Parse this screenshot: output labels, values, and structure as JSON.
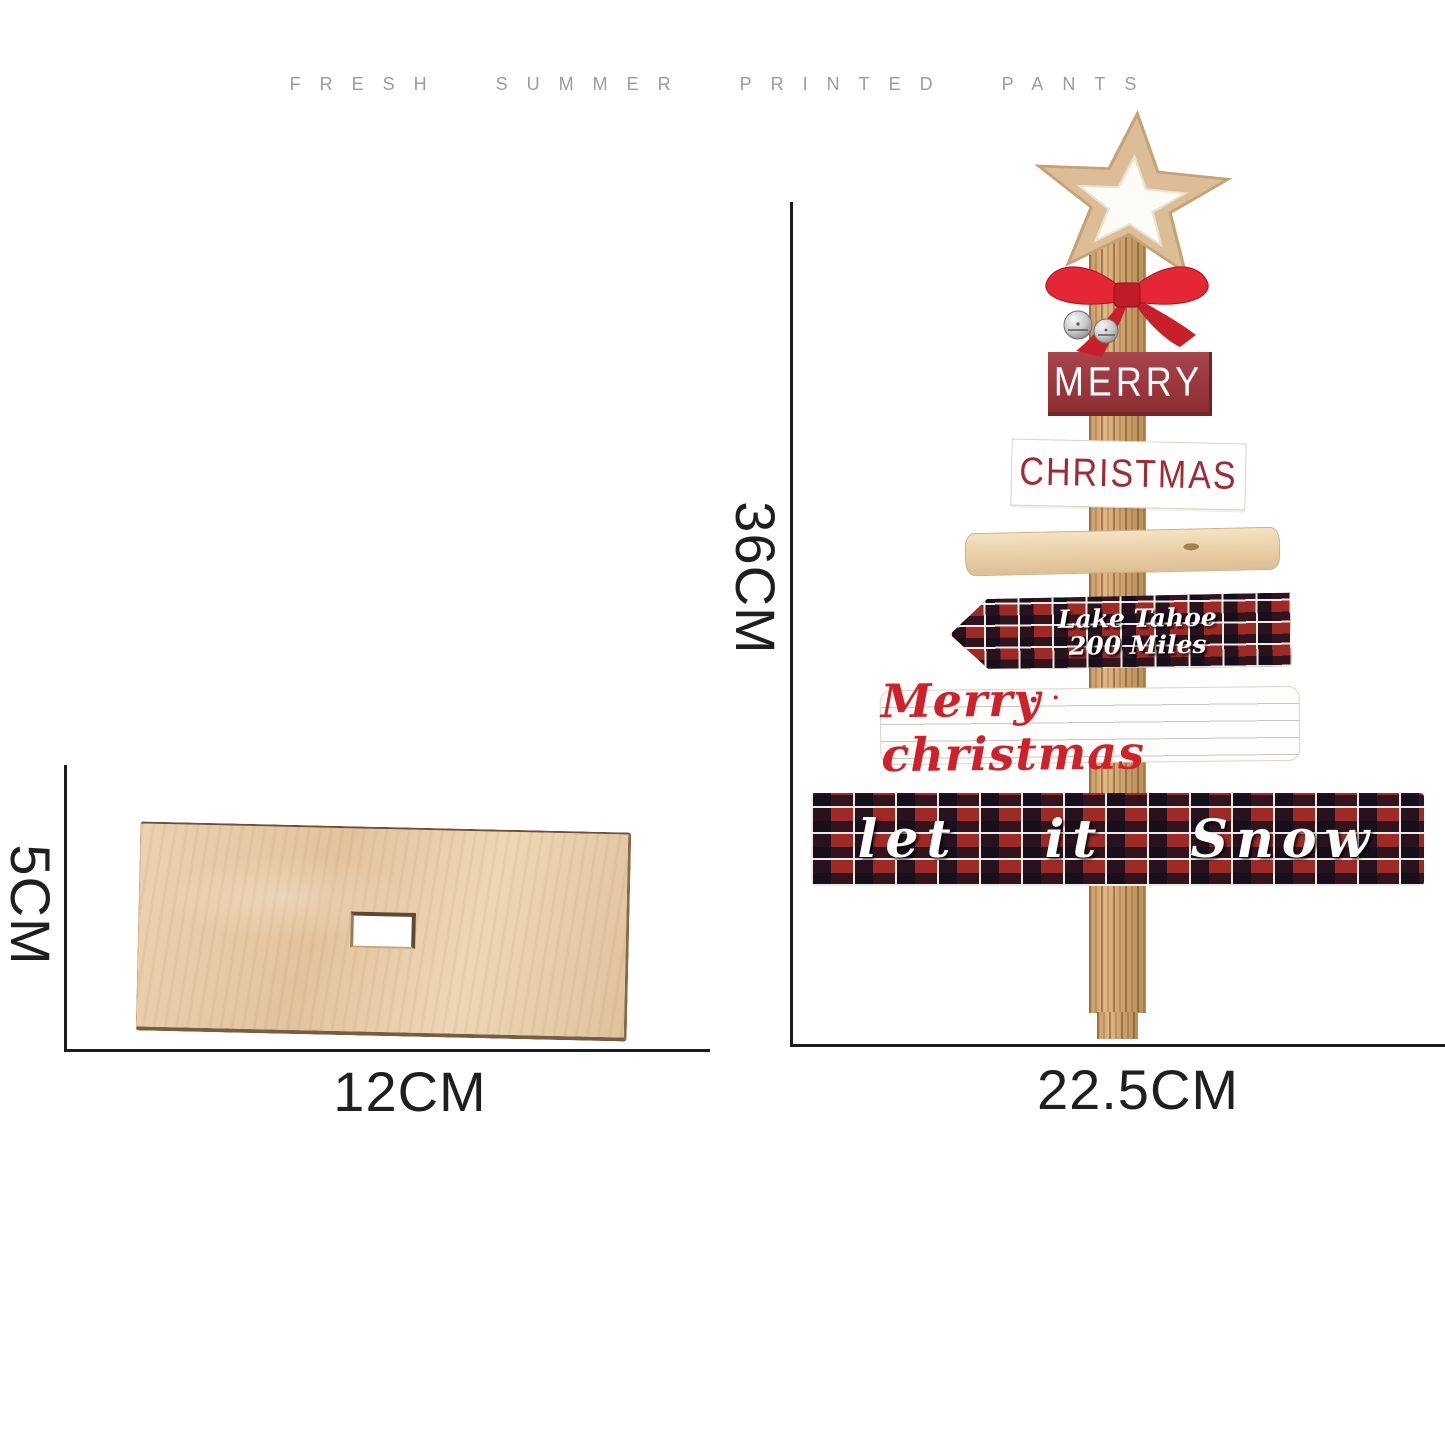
{
  "header": {
    "caption": "FRESH SUMMER PRINTED PANTS"
  },
  "base_diagram": {
    "height_label": "5CM",
    "width_label": "12CM"
  },
  "tree_diagram": {
    "height_label": "36CM",
    "width_label": "22.5CM",
    "top_sign": "MERRY",
    "second_sign": "CHRISTMAS",
    "arrow_sign_line1": "Lake Tahoe",
    "arrow_sign_line2": "200 Miles",
    "script_sign": "Merry christmas",
    "bottom_sign": "let it Snow",
    "decorations": [
      "wooden-star",
      "red-bow",
      "jingle-bells"
    ]
  },
  "colors": {
    "dimension_line": "#1c1c1c",
    "caption_gray": "#9c9c9c",
    "plate_wood": "#e9cfa9",
    "trunk_wood": "#cda06c",
    "merry_sign_red": "#96343a",
    "christmas_text_red": "#9e2d33",
    "script_text_red": "#cf2129",
    "bow_red": "#e52635",
    "plaid_red": "#9e2a26",
    "plaid_dark": "#120e1c",
    "white": "#ffffff"
  }
}
